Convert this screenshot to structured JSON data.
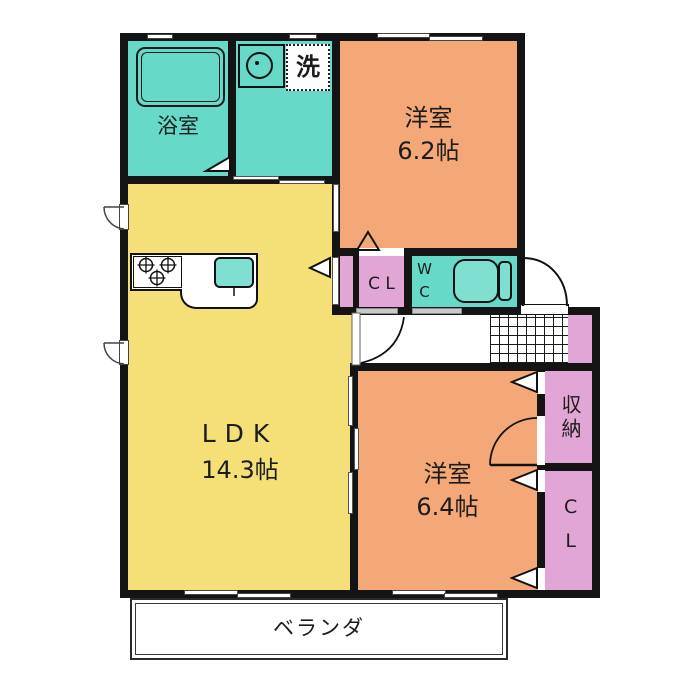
{
  "colors": {
    "wall": "#141414",
    "teal": "#66d9c9",
    "orange": "#f4a878",
    "yellow": "#f5df77",
    "pink": "#e2a6d6",
    "fixture-teal": "#7fe0d2"
  },
  "rooms": {
    "bathroom": {
      "label": "浴室"
    },
    "laundry_space": {
      "label": "洗"
    },
    "bedroom_top": {
      "label": "洋室",
      "size": "6.2帖"
    },
    "closet_mid": {
      "label": "C L"
    },
    "toilet": {
      "label": "WC"
    },
    "ldk": {
      "label": "LDK",
      "size": "14.3帖"
    },
    "bedroom_bottom": {
      "label": "洋室",
      "size": "6.4帖"
    },
    "storage": {
      "label": "収納"
    },
    "closet_right": {
      "label": "CL"
    },
    "veranda": {
      "label": "ベランダ"
    }
  }
}
